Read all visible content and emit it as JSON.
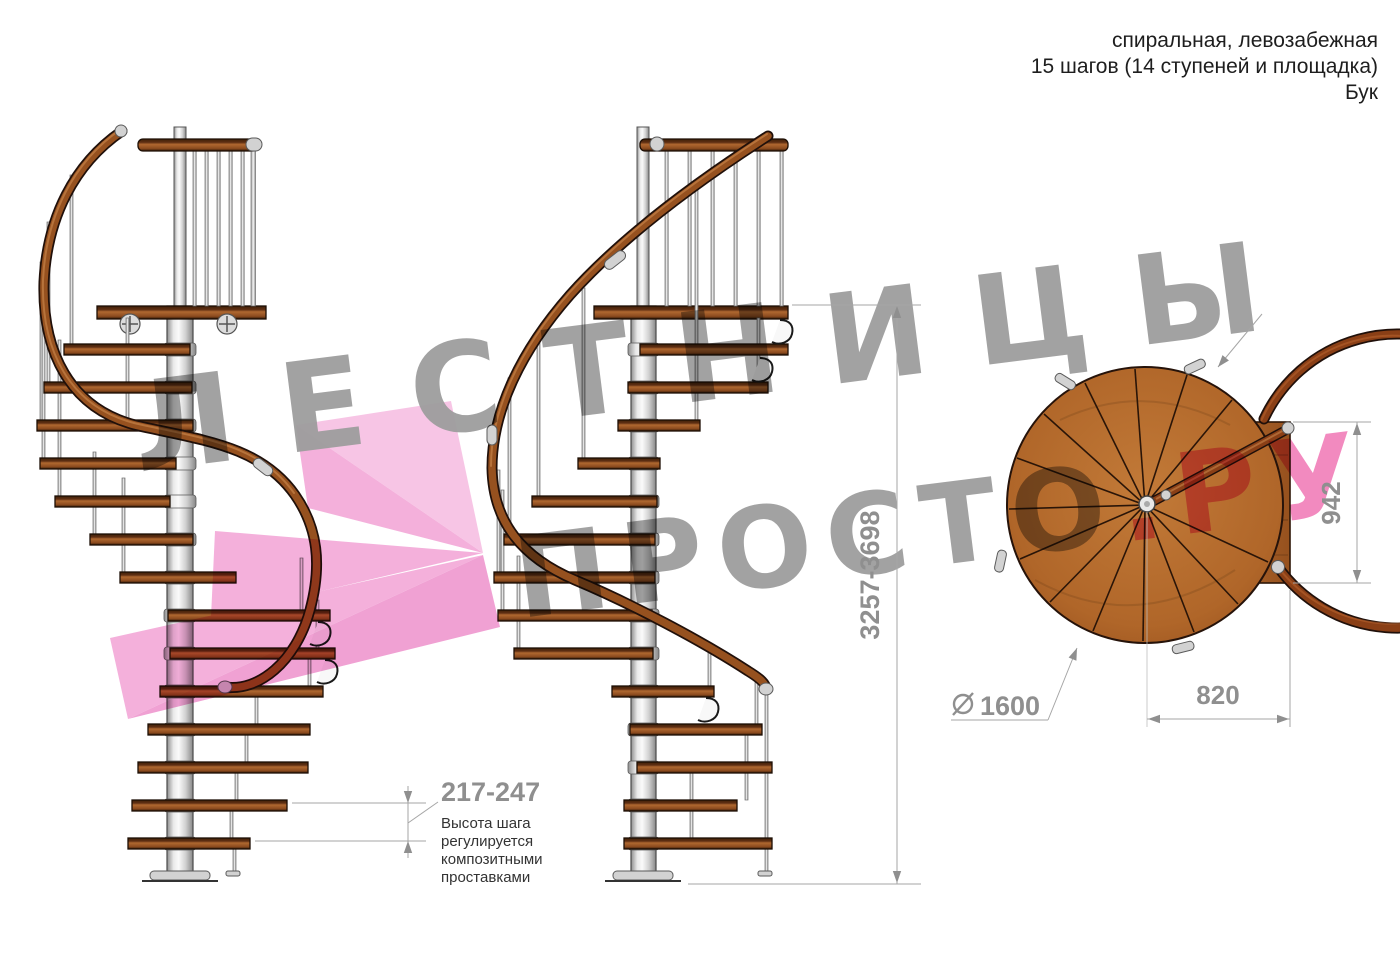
{
  "title_block": {
    "line1": "спиральная, левозабежная",
    "line2": "15 шагов (14 ступеней и площадка)",
    "line3": "Бук"
  },
  "watermark": {
    "line1": "ЛЕСТНИЦЫ",
    "line2_gray": "ПРОСТО",
    "line2_pink": ".РУ"
  },
  "dimensions": {
    "step_height": {
      "value": "217-247",
      "note_lines": [
        "Высота шага",
        "регулируется",
        "композитными",
        "проставками"
      ]
    },
    "total_height": {
      "value": "3257-3698"
    },
    "landing_side": {
      "value": "942"
    },
    "landing_width": {
      "value": "820"
    },
    "diameter": {
      "symbol": "⌀",
      "value": "1600"
    }
  },
  "colors": {
    "accent_pink": "#ee5ba6",
    "logo_pink_light": "#f7bfe3",
    "logo_pink_mid": "#f3a8d8",
    "logo_pink_dark": "#ef97cf",
    "watermark_gray": "#9e9e9e",
    "dim_gray": "#8f8f8f",
    "wood_brown": "#a55c24",
    "rail_brown": "#96511f",
    "steel_gray": "#d9d9d9"
  }
}
